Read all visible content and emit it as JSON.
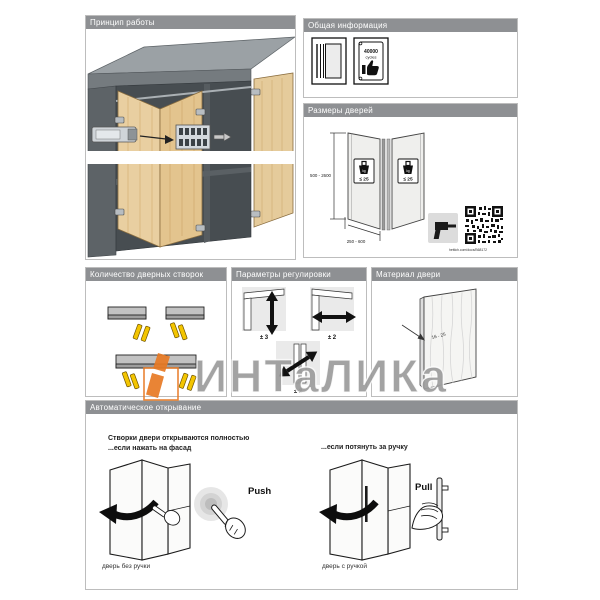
{
  "watermark": {
    "text": "ИНТаЛИКа",
    "accent_color": "#e87a24"
  },
  "colors": {
    "header_gray": "#8e9093",
    "wood": "#e9cfa1",
    "highlight_yellow": "#f3c500",
    "watermark_orange": "#e87a24"
  },
  "panels": {
    "principle": {
      "title": "Принцип работы"
    },
    "general_info": {
      "title": "Общая информация",
      "icons": [
        {
          "name": "catalog-icon"
        },
        {
          "name": "cycles-certificate-icon",
          "value": "40000",
          "unit": "cycles"
        }
      ],
      "cycles_value": "40000",
      "cycles_unit": "cycles"
    },
    "door_sizes": {
      "title": "Размеры дверей",
      "height_range": "500 - 2600",
      "width_range": "250 - 600",
      "weight_unit": "kg",
      "weight_limit": "≤ 25",
      "link": "hettich.com/docs/B68172"
    },
    "leaf_count": {
      "title": "Количество дверных створок"
    },
    "adjustment": {
      "title": "Параметры регулировки",
      "vertical": "± 3",
      "horizontal": "± 2",
      "gap": "± 2"
    },
    "door_material": {
      "title": "Материал двери",
      "thickness": "16 - 25"
    },
    "auto_opening": {
      "title": "Автоматическое открывание",
      "heading_line1": "Створки двери открываются полностью",
      "heading_line2": "...если нажать на фасад",
      "right_heading": "...если потянуть за ручку",
      "push_label": "Push",
      "pull_label": "Pull",
      "caption_left": "дверь без ручки",
      "caption_right": "дверь с ручкой"
    }
  }
}
